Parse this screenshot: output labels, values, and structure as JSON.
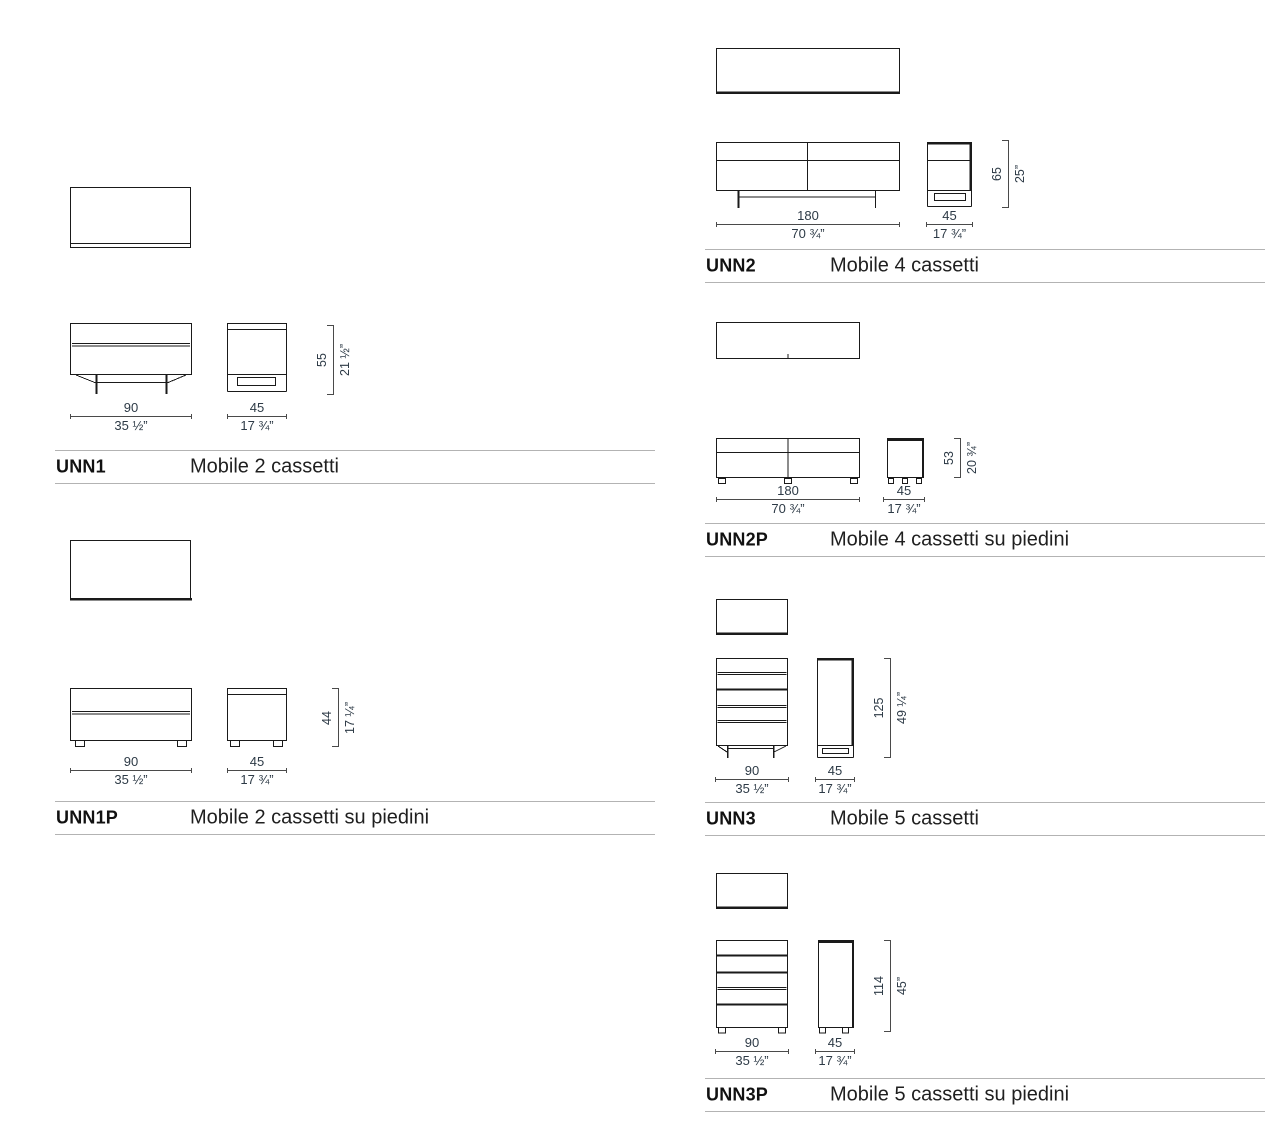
{
  "colors": {
    "background": "#ffffff",
    "drawing_line": "#1a1a1a",
    "dimension_text": "#2d3a46",
    "separator_line": "#b3b3b3",
    "label_text": "#111111"
  },
  "sections": [
    {
      "id": "UNN1",
      "code": "UNN1",
      "name": "Mobile 2 cassetti",
      "front": {
        "cm": "90",
        "in": "35 ½”"
      },
      "side": {
        "cm": "45",
        "in": "17 ¾”"
      },
      "height": {
        "cm": "55",
        "in": "21 ½”"
      }
    },
    {
      "id": "UNN1P",
      "code": "UNN1P",
      "name": "Mobile 2 cassetti su piedini",
      "front": {
        "cm": "90",
        "in": "35 ½”"
      },
      "side": {
        "cm": "45",
        "in": "17 ¾”"
      },
      "height": {
        "cm": "44",
        "in": "17 ¼”"
      }
    },
    {
      "id": "UNN2",
      "code": "UNN2",
      "name": "Mobile 4 cassetti",
      "front": {
        "cm": "180",
        "in": "70 ¾”"
      },
      "side": {
        "cm": "45",
        "in": "17 ¾”"
      },
      "height": {
        "cm": "65",
        "in": "25”"
      }
    },
    {
      "id": "UNN2P",
      "code": "UNN2P",
      "name": "Mobile 4 cassetti su piedini",
      "front": {
        "cm": "180",
        "in": "70 ¾”"
      },
      "side": {
        "cm": "45",
        "in": "17 ¾”"
      },
      "height": {
        "cm": "53",
        "in": "20 ¾”"
      }
    },
    {
      "id": "UNN3",
      "code": "UNN3",
      "name": "Mobile 5 cassetti",
      "front": {
        "cm": "90",
        "in": "35 ½”"
      },
      "side": {
        "cm": "45",
        "in": "17 ¾”"
      },
      "height": {
        "cm": "125",
        "in": "49 ¼”"
      }
    },
    {
      "id": "UNN3P",
      "code": "UNN3P",
      "name": "Mobile 5 cassetti su piedini",
      "front": {
        "cm": "90",
        "in": "35 ½”"
      },
      "side": {
        "cm": "45",
        "in": "17 ¾”"
      },
      "height": {
        "cm": "114",
        "in": "45”"
      }
    }
  ]
}
